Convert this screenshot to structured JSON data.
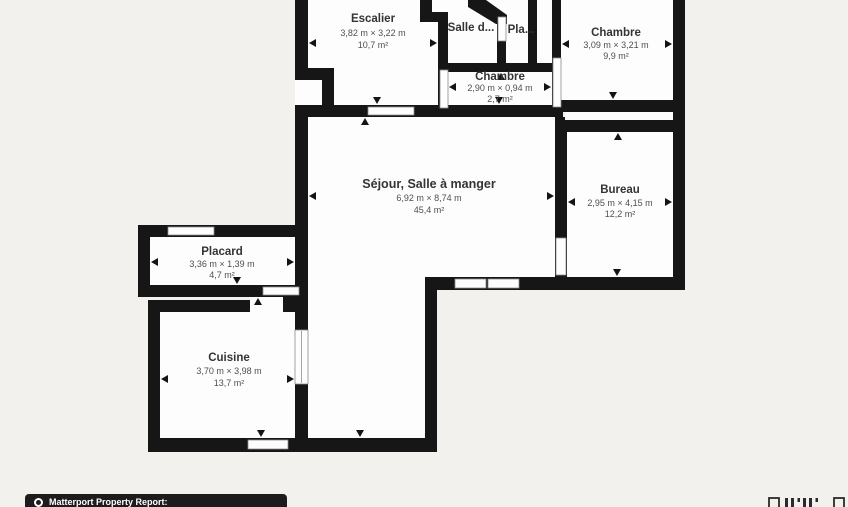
{
  "page": {
    "background_color": "#f2f1ee",
    "wall_color": "#161616",
    "room_fill": "#fdfdfd",
    "text_color": "#343434"
  },
  "rooms": [
    {
      "id": "escalier",
      "name": "Escalier",
      "dimensions": "3,82 m × 3,22 m",
      "area": "10,7 m²"
    },
    {
      "id": "salle-deau",
      "name": "Salle d...",
      "dimensions": "",
      "area": ""
    },
    {
      "id": "placard-haut",
      "name": "Pla...",
      "dimensions": "",
      "area": ""
    },
    {
      "id": "chambre-1",
      "name": "Chambre",
      "dimensions": "3,09 m × 3,21 m",
      "area": "9,9 m²"
    },
    {
      "id": "chambre-2",
      "name": "Chambre",
      "dimensions": "2,90 m × 0,94 m",
      "area": "2,7 m²"
    },
    {
      "id": "sejour",
      "name": "Séjour, Salle à manger",
      "dimensions": "6,92 m × 8,74 m",
      "area": "45,4 m²"
    },
    {
      "id": "bureau",
      "name": "Bureau",
      "dimensions": "2,95 m × 4,15 m",
      "area": "12,2 m²"
    },
    {
      "id": "placard",
      "name": "Placard",
      "dimensions": "3,36 m × 1,39 m",
      "area": "4,7 m²"
    },
    {
      "id": "cuisine",
      "name": "Cuisine",
      "dimensions": "3,70 m × 3,98 m",
      "area": "13,7 m²"
    }
  ],
  "footer": {
    "label": "Matterport Property Report:"
  }
}
